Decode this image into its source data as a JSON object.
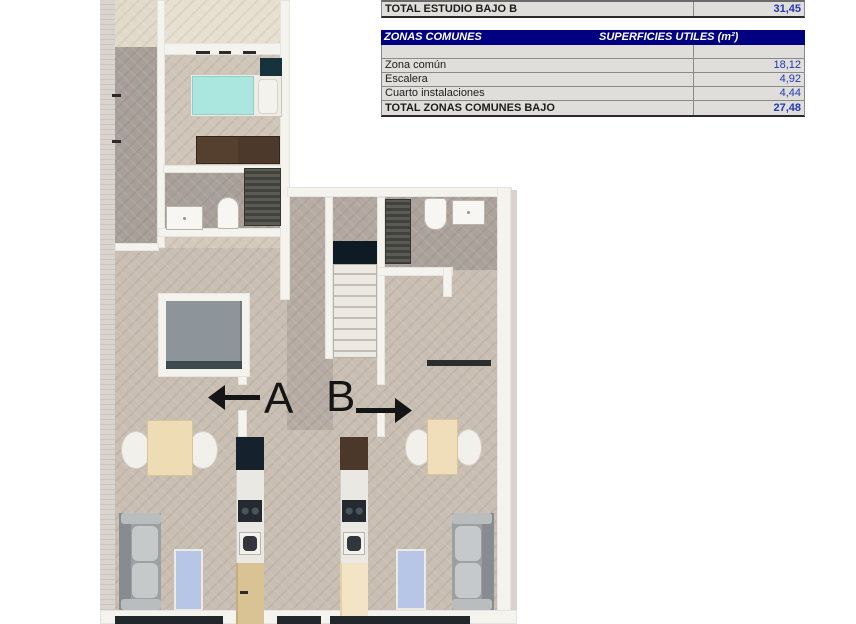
{
  "tables": {
    "estudio": {
      "total": {
        "label": "TOTAL ESTUDIO BAJO B",
        "value": "31,45"
      }
    },
    "zonas": {
      "header": {
        "left": "ZONAS COMUNES",
        "right": "SUPERFICIES UTILES  (m²)"
      },
      "rows": [
        {
          "label": "Zona común",
          "value": "18,12"
        },
        {
          "label": "Escalera",
          "value": "4,92"
        },
        {
          "label": "Cuarto instalaciones",
          "value": "4,44"
        }
      ],
      "total": {
        "label": "TOTAL ZONAS COMUNES BAJO",
        "value": "27,48"
      }
    }
  },
  "floorplan": {
    "unit_a_label": "A",
    "unit_b_label": "B"
  },
  "colors": {
    "header_navy": "#000080",
    "value_blue": "#2338b8",
    "mattress_teal": "#abe6df",
    "rug_blue": "#b7c6e7"
  }
}
